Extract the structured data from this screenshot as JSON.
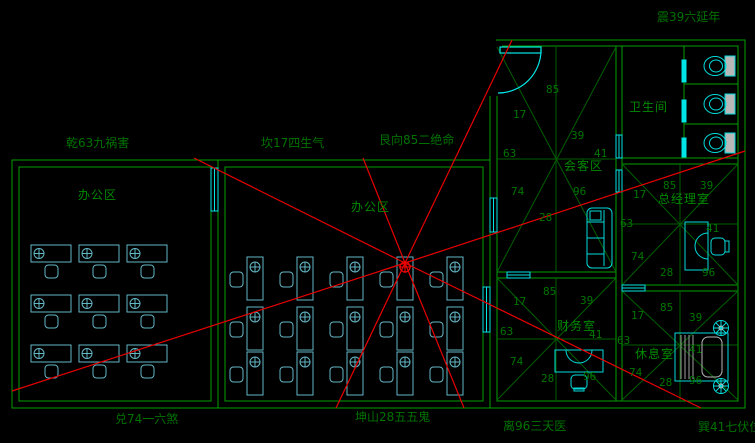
{
  "compass_labels": {
    "nw": "乾63九祸害",
    "n1": "坎17四生气",
    "n2": "艮向85二绝命",
    "ne": "震39六延年",
    "sw": "兑74一六煞",
    "s1": "坤山28五五鬼",
    "s2": "离96三天医",
    "se": "巽41七伏位"
  },
  "rooms": {
    "office_left": {
      "label": "办公区"
    },
    "office_mid": {
      "label": "办公区"
    },
    "bathroom": {
      "label": "卫生间"
    },
    "meeting": {
      "label": "会客区",
      "nums": {
        "t": "85",
        "tr": "39",
        "r": "41",
        "br": "96",
        "b": "28",
        "bl": "74",
        "l": "63",
        "tl": "17"
      }
    },
    "gm_office": {
      "label": "总经理室",
      "nums": {
        "t": "85",
        "tr": "39",
        "r": "41",
        "br": "96",
        "b": "28",
        "bl": "74",
        "l": "63",
        "tl": "17"
      }
    },
    "finance": {
      "label": "财务室",
      "nums": {
        "t": "85",
        "tr": "39",
        "r": "41",
        "br": "96",
        "b": "28",
        "bl": "74",
        "l": "63",
        "tl": "17"
      }
    },
    "rest": {
      "label": "休息室",
      "nums": {
        "t": "85",
        "tr": "39",
        "r": "41",
        "br": "96",
        "b": "28",
        "bl": "74",
        "l": "63",
        "tl": "17"
      }
    }
  },
  "colors": {
    "background": "#000000",
    "wall_green": "#00a000",
    "sector_line_green": "#006000",
    "annotation_green": "#007200",
    "furniture_cyan": "#00dcdc",
    "desk_cyan": "#63b8c6",
    "window_cyan": "#00e5e5",
    "analysis_red": "#e80000",
    "fixture_gray": "#b8b8b8"
  }
}
